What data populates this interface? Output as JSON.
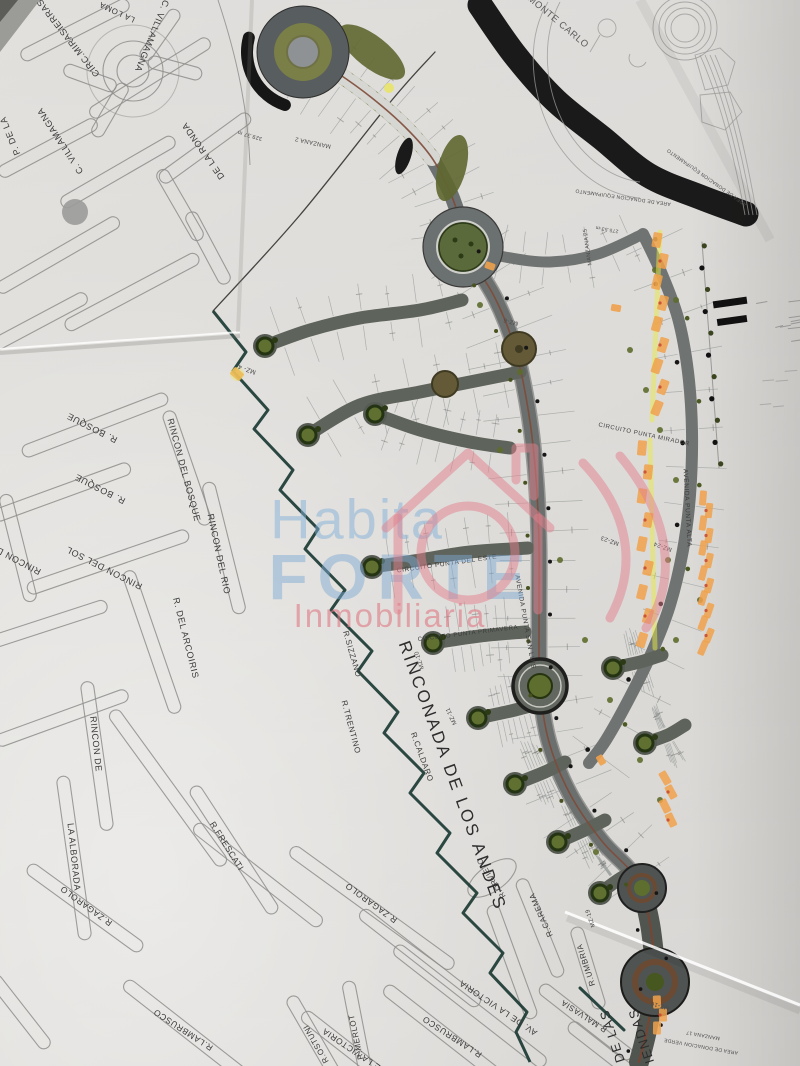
{
  "watermark": {
    "brand_top": "Habita",
    "brand_main": "FORTE",
    "brand_sub": "Inmobiliaria"
  },
  "labels": {
    "left": [
      "CIRC.MIRASIERRAS",
      "LA LOMA",
      "C. VILLAMAGNA",
      "P. DE LA",
      "C. VILLAMAGNA",
      "DE LA RONDA",
      "R. BOSQUE",
      "R. BOSQUE",
      "RINCON DEL BOSQUE",
      "RINCON DEL RIO",
      "RINCON DEL SOL",
      "RINCON DEL",
      "R. DEL ARCOIRIS",
      "RINCON DE",
      "LA ALBORADA",
      "R.FRESCATI",
      "R.ZAGAROLO",
      "R.ZAGAROLO",
      "R.MERLOT",
      "R.OSTUNI",
      "R.LAMBRUSCO",
      "R.LAMBRUSCO",
      "AV. DE LA VICTORIA",
      "AV. DE LA VICTORIA",
      "R.CAREMA",
      "R.UMBRIA",
      "R.MALVASIA",
      "R.SIZZANO",
      "R.TRENTINO",
      "R.ORVIETO",
      "R.CALDARO"
    ],
    "dev": [
      "RINCONADA DE LOS ANDES",
      "MONTE CARLO",
      "CIRCUITO PUNTA DEL ESTE",
      "CIRCUITO PUNTA PRIMAVERA",
      "AVENIDA PUNTA SAN LUIS",
      "AVENIDA PUNTA ALTA",
      "CIRCUITO PUNTA MIRADOR",
      "DE LAS",
      "VIVIENDAS"
    ],
    "small": [
      "MANZANA 2",
      "329.37 m",
      "MANZANA 25",
      "275.53 m",
      "AREA DE DONACION EQUIPAMENTO",
      "AREA DE DONACION EQUIPAMENTO",
      "MANZANA 17",
      "AREA DE DONACION VERDE",
      "MZ- 4",
      "MZ-6",
      "MZ-10",
      "MZ-11",
      "MZ-16",
      "MZ-19",
      "MZ-23",
      "MZ-24"
    ]
  },
  "colors": {
    "road_gray": "#6b706e",
    "boundary_teal": "#1b3a33",
    "sold_lot_orange": "#f0a14b",
    "highlighter_yellow": "#e7ea45",
    "tree_olive": "#5f7030",
    "watermark_blue": "#82afd7",
    "watermark_pink": "#de7882"
  }
}
